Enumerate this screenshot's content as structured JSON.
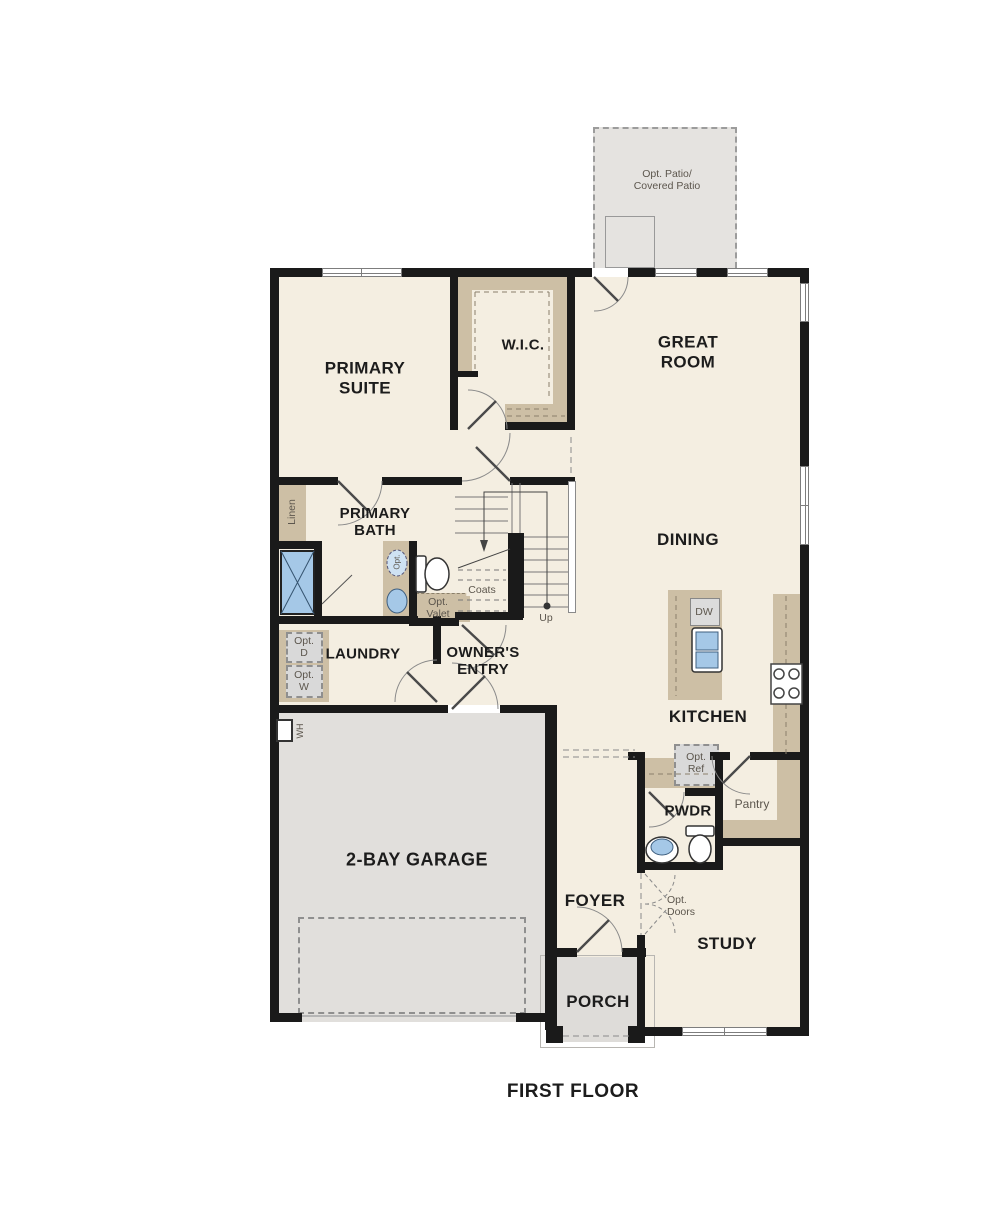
{
  "title": "FIRST FLOOR",
  "colors": {
    "wall": "#1a1a1a",
    "floor": "#f4eee1",
    "casework": "#cdbfa5",
    "garage_floor": "#e1dfdc",
    "patio_floor": "#e5e3e0",
    "porch_floor": "#dedcd9",
    "fixture_blue": "#a5c8e7",
    "line_gray": "#8a8a8a",
    "label_dark": "#1c1c1c",
    "label_gray": "#5c564d"
  },
  "labels": {
    "patio": "Opt. Patio/\nCovered Patio",
    "primary_suite": "PRIMARY\nSUITE",
    "wic": "W.I.C.",
    "great_room": "GREAT\nROOM",
    "dining": "DINING",
    "kitchen": "KITCHEN",
    "dw": "DW",
    "opt_ref": "Opt.\nRef",
    "pantry": "Pantry",
    "pwdr": "PWDR",
    "primary_bath": "PRIMARY\nBATH",
    "linen": "Linen",
    "opt_sink": "Opt.",
    "coats": "Coats",
    "up": "Up",
    "opt_valet": "Opt.\nValet",
    "laundry": "LAUNDRY",
    "opt_dryer": "Opt.\nD",
    "opt_washer": "Opt.\nW",
    "owners_entry": "OWNER'S\nENTRY",
    "garage": "2-BAY GARAGE",
    "water_heater": "WH",
    "foyer": "FOYER",
    "opt_doors": "Opt.\nDoors",
    "study": "STUDY",
    "porch": "PORCH"
  }
}
